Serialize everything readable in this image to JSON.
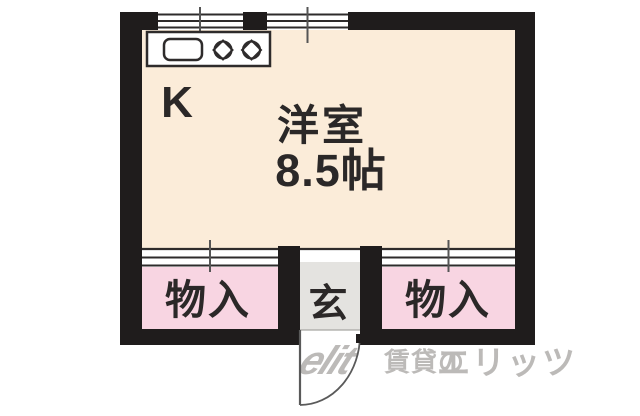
{
  "colors": {
    "wall": "#1f1c1c",
    "line": "#2e2b2b",
    "tick": "#555555",
    "room_floor": "#fbecd9",
    "closet_pink": "#f8d5e2",
    "entrance_gray": "#e4e3e0",
    "fixture_white": "#ffffff",
    "label_text": "#2b2828",
    "door_stroke": "#5a5a5a",
    "watermark_gray": "#b9b7b5",
    "background": "#ffffff"
  },
  "floorplan": {
    "kitchen": {
      "label": "K",
      "fixture_icons": [
        "sink-icon",
        "burner-icon",
        "burner-icon"
      ]
    },
    "main_room": {
      "label": "洋室",
      "size": "8.5帖"
    },
    "closet_left": {
      "label": "物入"
    },
    "closet_right": {
      "label": "物入"
    },
    "entrance": {
      "label": "玄"
    },
    "features": {
      "top_windows": 2,
      "entry_door": "quarter-circle swing door at bottom center"
    }
  },
  "watermark": {
    "logo": "elit",
    "prefix": "賃貸の",
    "brand": "エリッツ"
  }
}
